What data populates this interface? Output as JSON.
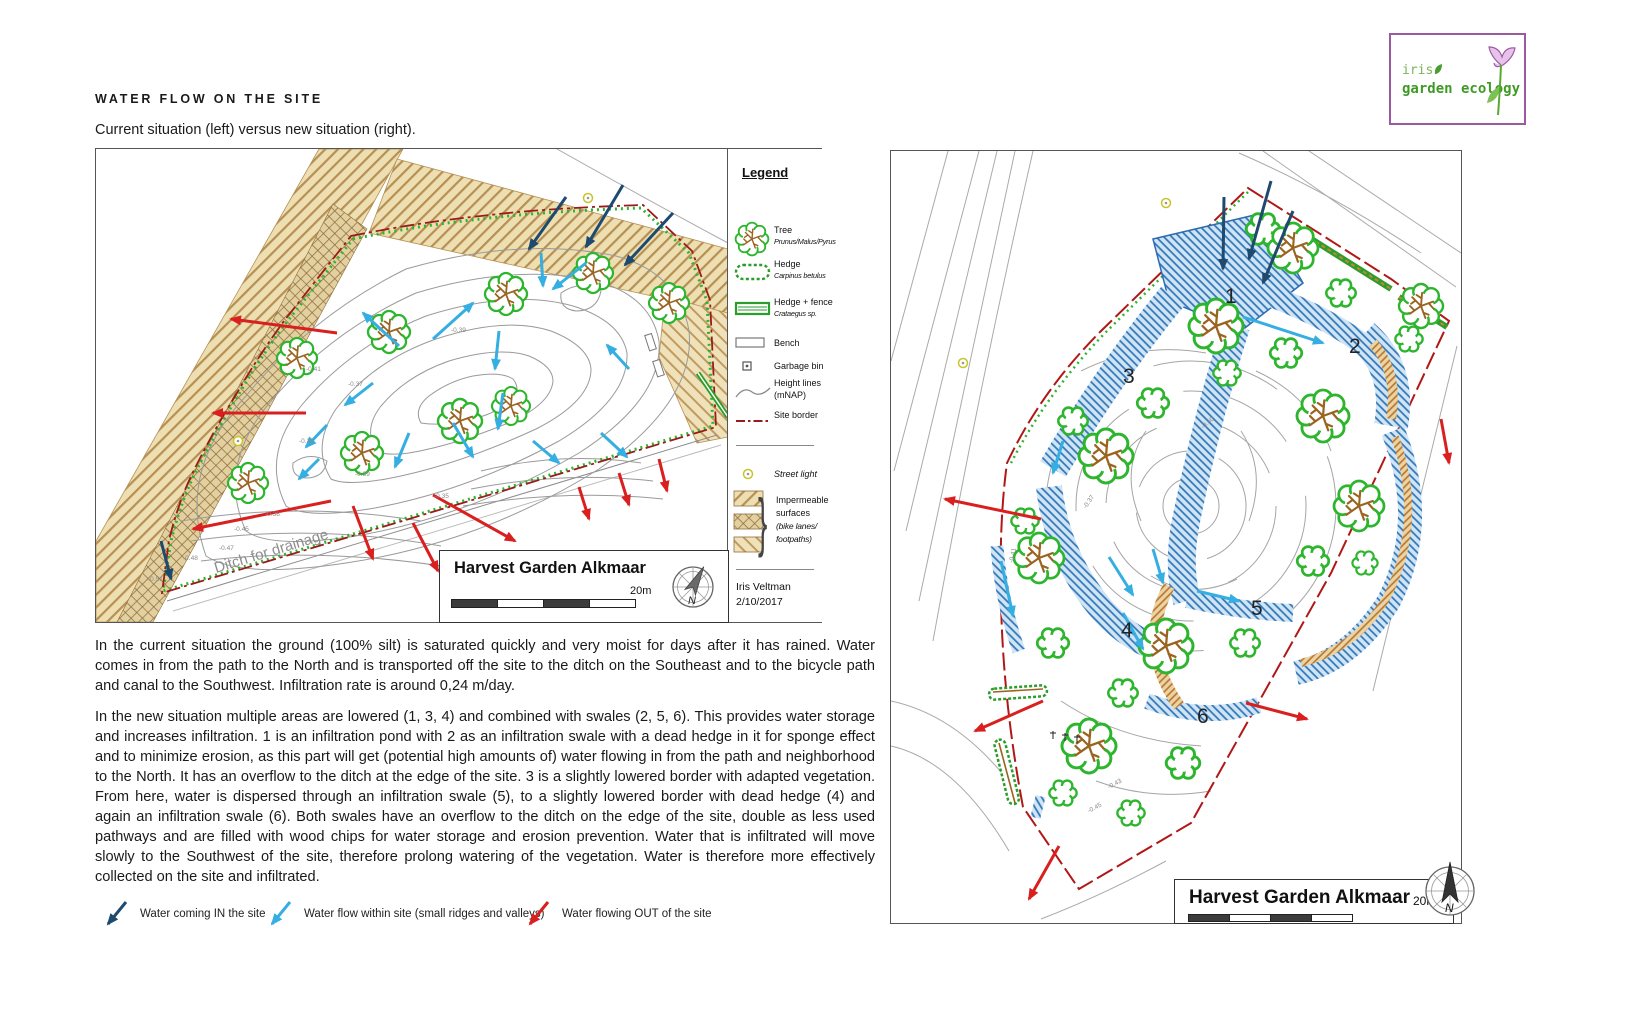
{
  "header": {
    "title": "WATER FLOW ON THE SITE",
    "subtitle": "Current situation (left) versus new situation (right)."
  },
  "logo": {
    "name": "iris",
    "tagline": "garden ecology"
  },
  "legend": {
    "title": "Legend",
    "tree_label": "Tree",
    "tree_species": "Prunus/Malus/Pyrus",
    "hedge_label": "Hedge",
    "hedge_species": "Carpinus betulus",
    "hedge_fence_label": "Hedge + fence",
    "hedge_fence_species": "Crataegus sp.",
    "bench_label": "Bench",
    "garbage_label": "Garbage bin",
    "height_label": "Height lines",
    "height_label2": "(mNAP)",
    "border_label": "Site border",
    "street_light_label": "Street light",
    "imp1": "Impermeable",
    "imp2": "surfaces",
    "imp3": "(bike lanes/",
    "imp4": "footpaths)",
    "credit_name": "Iris Veltman",
    "credit_date": "2/10/2017"
  },
  "left_map": {
    "title": "Harvest Garden Alkmaar",
    "scale_label": "20m",
    "compass_n": "N",
    "ditch_label": "Ditch for drainage",
    "contour_labels": [
      "-0.41",
      "-0.37",
      "-0.39",
      "-0.39",
      "-0.35",
      "-0.36",
      "-0.38",
      "-0.45",
      "-0.47",
      "-0.48",
      "-0.51"
    ]
  },
  "right_map": {
    "title": "Harvest Garden Alkmaar",
    "scale_label": "20m",
    "compass_n": "N",
    "area_numbers": [
      "1",
      "2",
      "3",
      "4",
      "5",
      "6"
    ],
    "contour_labels": [
      "-0.37",
      "-0.41",
      "-0.50",
      "-0.43",
      "-0.45"
    ]
  },
  "paragraphs": {
    "p1": "In the current situation the ground (100% silt) is saturated quickly and very moist for days after it has rained. Water comes in from the path to the North and is transported off the site to the ditch on the Southeast and to the bicycle path and canal to the Southwest. Infiltration rate is around 0,24 m/day.",
    "p2": "In the new situation multiple areas are lowered (1, 3, 4) and combined with swales (2, 5, 6). This provides water storage and increases infiltration. 1 is an infiltration pond with 2 as an infiltration swale with a dead hedge in it for sponge effect and to minimize erosion, as this part will get (potential high amounts of) water flowing in from the path and neighborhood to the North. It has an overflow to the ditch at the edge of the site. 3 is a slightly lowered border with adapted vegetation. From here, water is dispersed through an infiltration swale (5), to a slightly lowered border with dead hedge (4) and again an infiltration swale (6). Both swales have an overflow to the ditch on the edge of the site, double as less used pathways and are filled with wood chips for water storage and erosion prevention. Water that is infiltrated will move slowly to the Southwest of the site, therefore prolong watering of the vegetation. Water is therefore more effectively collected on the site and infiltrated."
  },
  "arrow_key": {
    "in_label": "Water coming IN the site",
    "within_label": "Water flow within site (small ridges and valleys)",
    "out_label": "Water flowing OUT of the site"
  }
}
